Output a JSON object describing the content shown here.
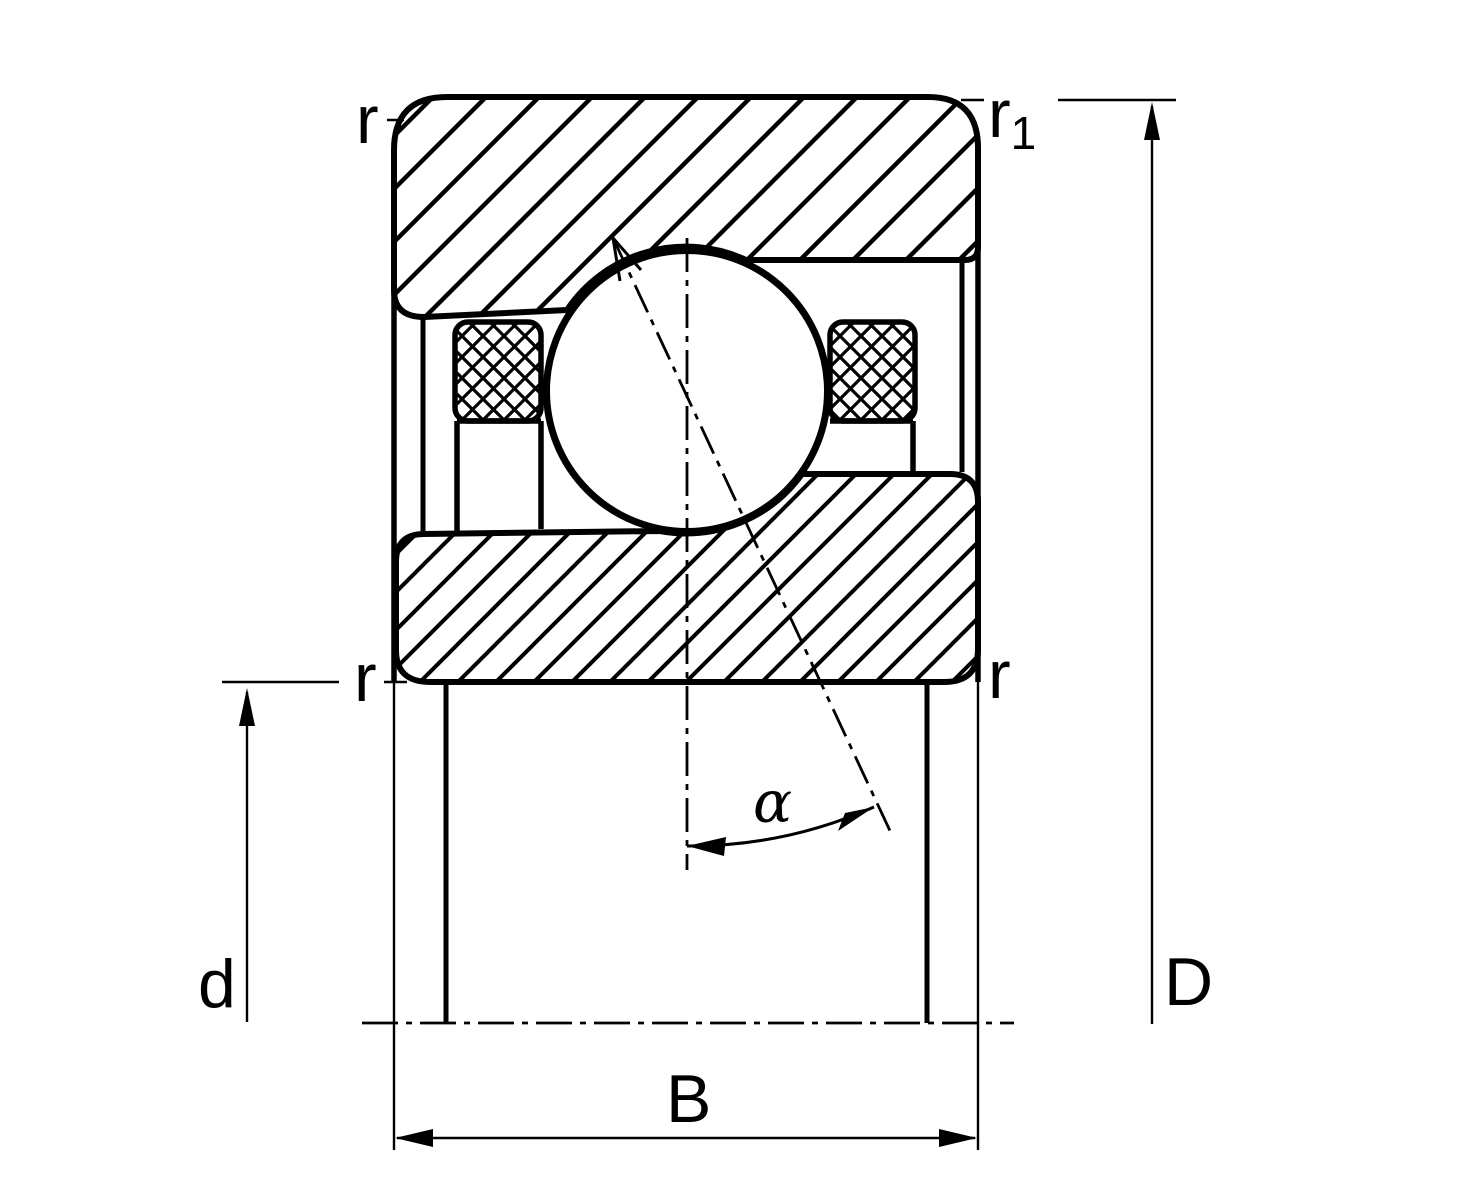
{
  "diagram": {
    "type": "bearing-cross-section",
    "description": "Angular contact ball bearing sectional drawing with dimension symbols",
    "labels": {
      "corner_radius_top_left": "r",
      "corner_radius_top_right_base": "r",
      "corner_radius_top_right_sub": "1",
      "corner_radius_mid_left": "r",
      "corner_radius_mid_right": "r",
      "bore_diameter": "d",
      "outside_diameter": "D",
      "width": "B",
      "contact_angle": "α"
    },
    "colors": {
      "line": "#000000",
      "background": "#ffffff"
    },
    "contact_angle_degrees": 25
  }
}
